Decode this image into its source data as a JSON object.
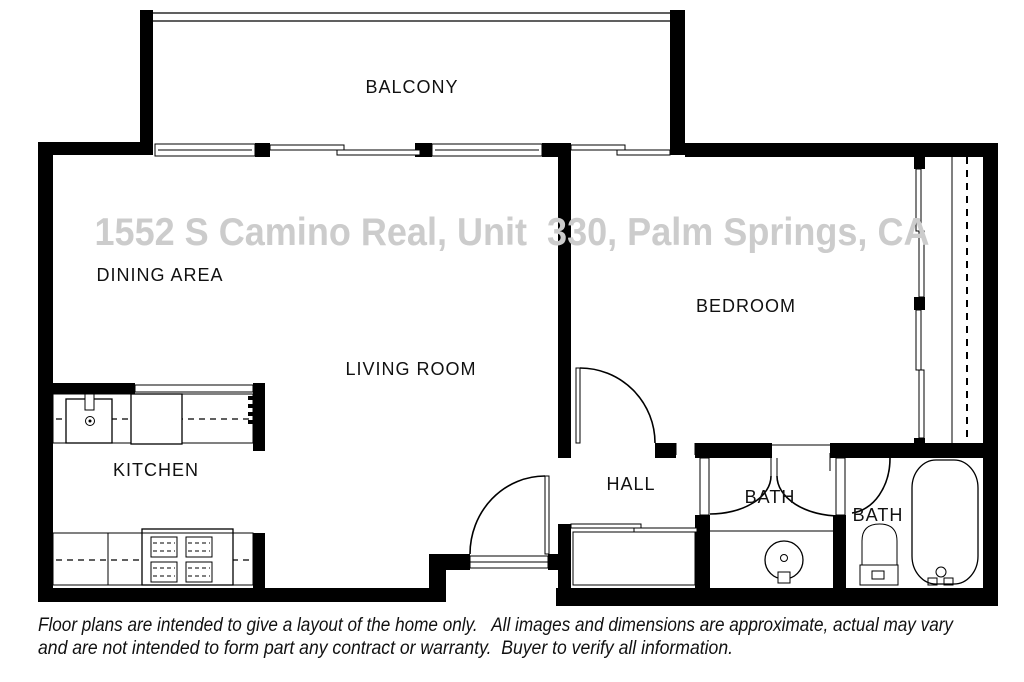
{
  "watermark": {
    "text": "1552 S Camino Real, Unit  330, Palm Springs, CA",
    "color": "#cccccc"
  },
  "rooms": [
    {
      "id": "balcony",
      "label": "BALCONY"
    },
    {
      "id": "dining-area",
      "label": "DINING AREA"
    },
    {
      "id": "bedroom",
      "label": "BEDROOM"
    },
    {
      "id": "living-room",
      "label": "LIVING ROOM"
    },
    {
      "id": "kitchen",
      "label": "KITCHEN"
    },
    {
      "id": "hall",
      "label": "HALL"
    },
    {
      "id": "bath-1",
      "label": "BATH"
    },
    {
      "id": "bath-2",
      "label": "BATH"
    }
  ],
  "disclaimer": {
    "line1": "Floor plans are intended to give a layout of the home only.   All images and dimensions are approximate, actual may vary",
    "line2": "and are not intended to form part any contract or warranty.  Buyer to verify all information."
  },
  "fixtures": [
    "kitchen-sink",
    "refrigerator",
    "range-stove",
    "kitchen-counter",
    "kitchen-pass-through",
    "balcony-railing",
    "window",
    "sliding-door",
    "entry-door",
    "bedroom-door",
    "bedroom-closet-sliding-door",
    "closet-rod",
    "hall-closet",
    "bath-double-doors",
    "pocket-door",
    "vanity-counter",
    "pedestal-sink",
    "toilet",
    "bathtub",
    "bath-door"
  ],
  "colors": {
    "wall": "#000000",
    "background": "#ffffff",
    "line": "#000000",
    "watermark": "#cccccc",
    "label": "#111111"
  }
}
